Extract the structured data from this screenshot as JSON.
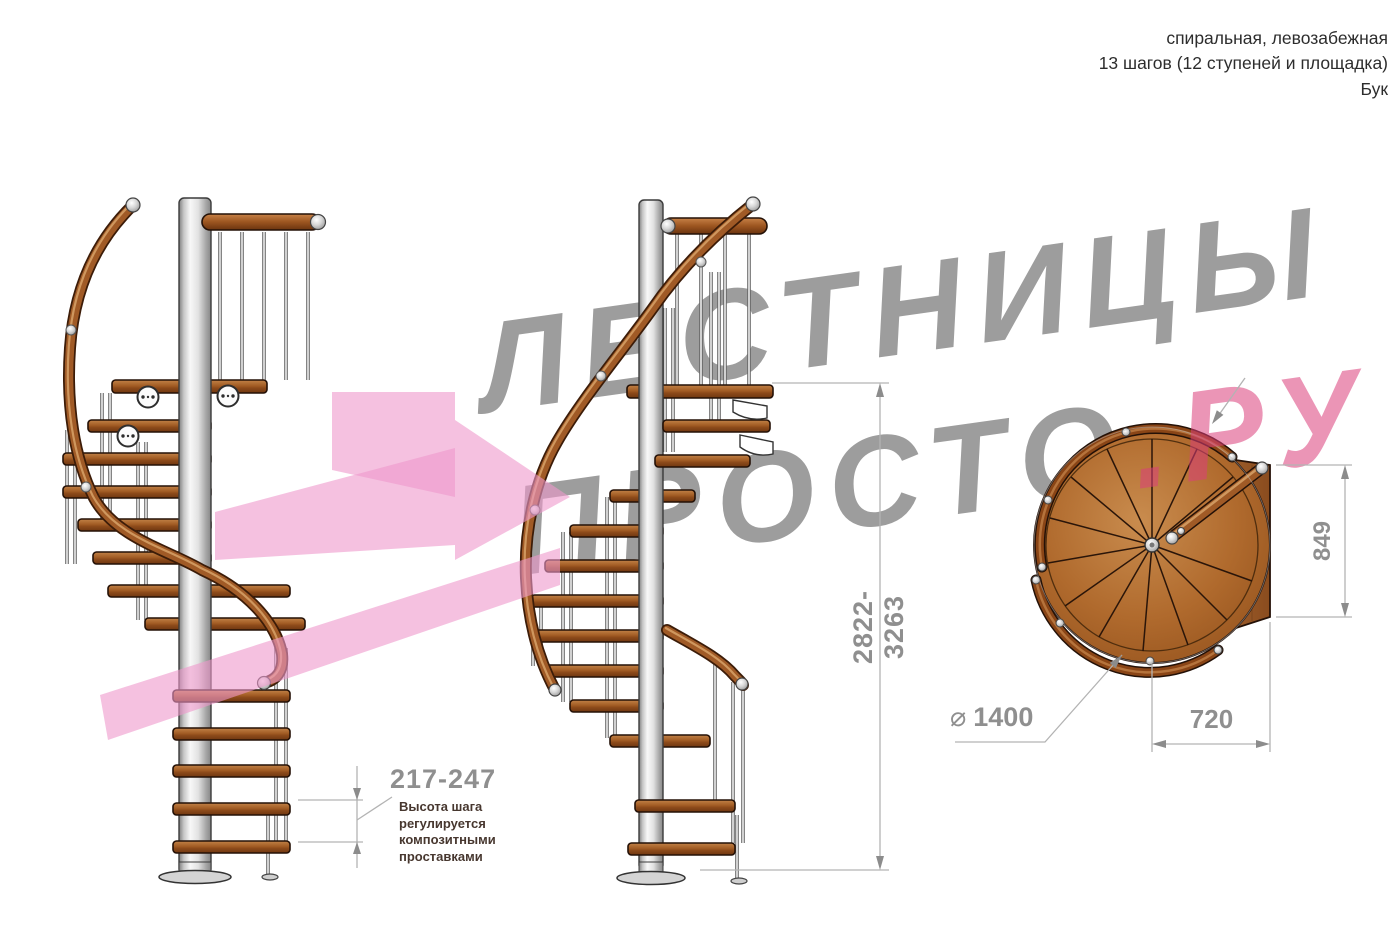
{
  "header": {
    "type_line": "спиральная, левозабежная",
    "steps_line": "13 шагов (12 ступеней и площадка)",
    "material_line": "Бук"
  },
  "watermark": {
    "line1": "ЛЕСТНИЦЫ",
    "line2_gray": "ПРОСТО",
    "line2_pink": ".РУ"
  },
  "dimensions": {
    "total_height": "2822-3263",
    "step_height": "217-247",
    "note_lines": [
      "Высота шага",
      "регулируется",
      "композитными",
      "проставками"
    ],
    "plan_width": "849",
    "plan_platform_depth": "720",
    "diameter_symbol": "⌀",
    "diameter_value": "1400"
  },
  "colors": {
    "dimension_gray": "#8f8f8f",
    "dimension_line": "#b3b3b3",
    "note_brown": "#47372f",
    "watermark_gray": "#9d9d9d",
    "watermark_pink": "#db3e7a",
    "arrow_pink": "#ef97cc",
    "wood_brown": "#a05c28",
    "handrail_brown": "#8a4516",
    "metal_silver": "#d9d9d9"
  }
}
